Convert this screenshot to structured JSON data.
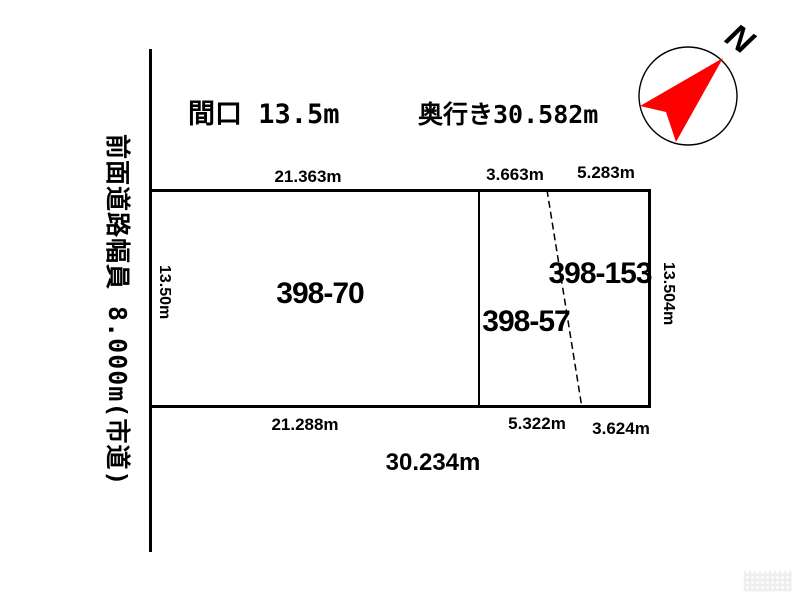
{
  "header": {
    "frontage": "間口 13.5m",
    "depth": "奥行き30.582m"
  },
  "road": {
    "label": "前面道路幅員 8.000m(市道)"
  },
  "compass": {
    "north_label": "N",
    "needle_color": "#ff0000"
  },
  "parcels": [
    {
      "id": "398-70"
    },
    {
      "id": "398-57"
    },
    {
      "id": "398-153"
    }
  ],
  "dimensions": {
    "top": [
      "21.363m",
      "3.663m",
      "5.283m"
    ],
    "bottom": [
      "21.288m",
      "5.322m",
      "3.624m"
    ],
    "left_side": "13.50m",
    "right_side": "13.504m",
    "total_bottom": "30.234m"
  },
  "colors": {
    "line": "#000000",
    "background": "#ffffff"
  }
}
